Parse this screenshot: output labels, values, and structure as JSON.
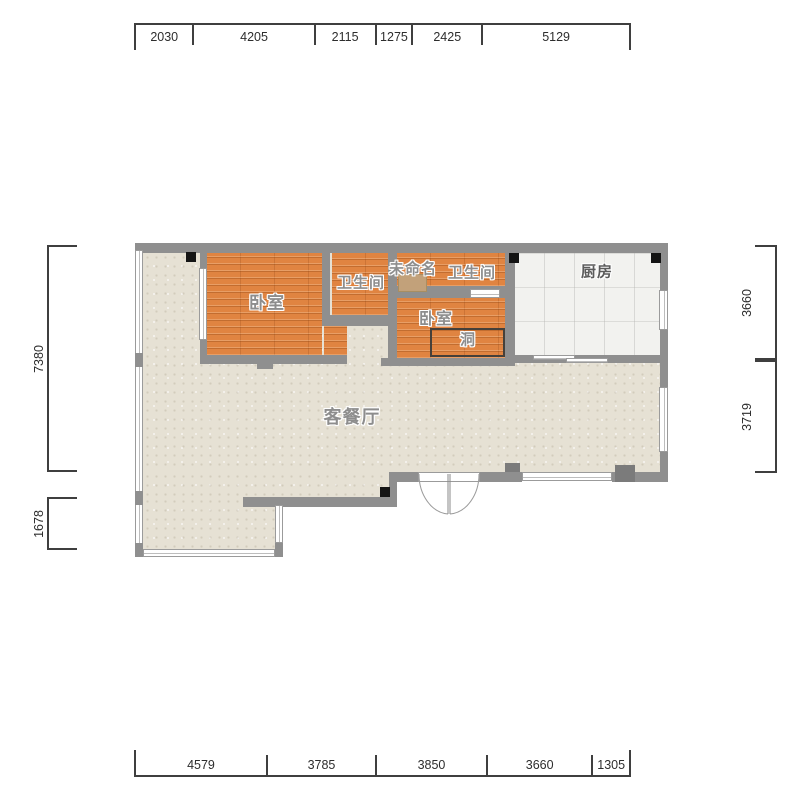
{
  "rooms": {
    "bedroom1": "卧室",
    "bathroom1": "卫生间",
    "unnamed": "未命名",
    "bathroom2": "卫生间",
    "kitchen": "厨房",
    "bedroom2": "卧室",
    "hole": "洞",
    "living": "客餐厅"
  },
  "dimensions": {
    "top": [
      2030,
      4205,
      2115,
      1275,
      2425,
      5129
    ],
    "bottom": [
      4579,
      3785,
      3850,
      3660,
      1305
    ],
    "left": [
      7380,
      1678
    ],
    "right": [
      3660,
      3719
    ]
  },
  "colors": {
    "wall": "#8f8f8f",
    "wood_floor": "#e08441",
    "living_floor": "#e6e1d4",
    "tile_floor": "#f2f2ef",
    "dimension": "#3f3f3f",
    "marker": "#141414"
  }
}
